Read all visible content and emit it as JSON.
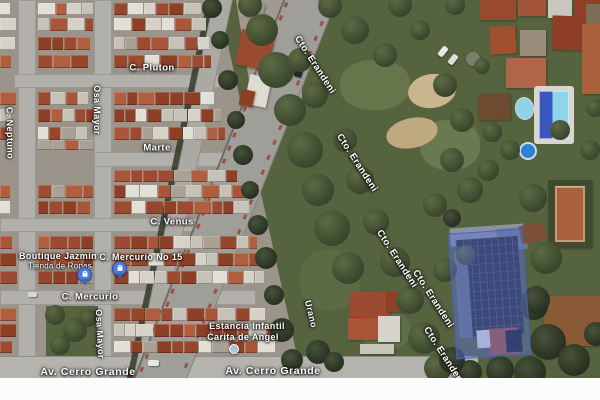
{
  "map": {
    "view_type": "satellite",
    "street_labels": [
      {
        "id": "pluton",
        "text": "C. Pluton"
      },
      {
        "id": "neptuno",
        "text": "C. Neptuno"
      },
      {
        "id": "osa-mayor-north",
        "text": "Osa Mayor"
      },
      {
        "id": "marte",
        "text": "Marte"
      },
      {
        "id": "venus",
        "text": "C. Venus"
      },
      {
        "id": "mercurio",
        "text": "C. Mercurio"
      },
      {
        "id": "osa-mayor-south",
        "text": "Osa Mayor"
      },
      {
        "id": "urano",
        "text": "Urano"
      },
      {
        "id": "cerro-grande-west",
        "text": "Av. Cerro Grande"
      },
      {
        "id": "cerro-grande-east",
        "text": "Av. Cerro Grande"
      },
      {
        "id": "erandeni-1",
        "text": "Cto. Erandeni"
      },
      {
        "id": "erandeni-2",
        "text": "Cto. Erandeni"
      },
      {
        "id": "erandeni-3",
        "text": "Cto. Erandeni"
      },
      {
        "id": "erandeni-4",
        "text": "Cto. Erandeni"
      },
      {
        "id": "erandeni-5",
        "text": "Cto. Erandeni"
      }
    ],
    "pois": {
      "boutique": {
        "name": "Boutique Jazmin",
        "category": "Tienda de Ropas"
      },
      "mercurio_store": {
        "name": "C. Mercurio No 15"
      },
      "estancia": {
        "line1": "Estancia Infantil",
        "line2": "Carita de Angel"
      }
    },
    "pins": [
      {
        "id": "shopping-pin-boutique",
        "type": "shopping"
      },
      {
        "id": "shopping-pin-mercurio-store",
        "type": "shopping"
      }
    ],
    "selection": {
      "description": "highlighted parcel polygon",
      "fill": "#5a73d7",
      "border": "#4661c8"
    },
    "colors": {
      "pin_blue": "#4d79dd",
      "poi_dot": "#a5c4d6",
      "pool_water": "#8ed4ec"
    }
  }
}
